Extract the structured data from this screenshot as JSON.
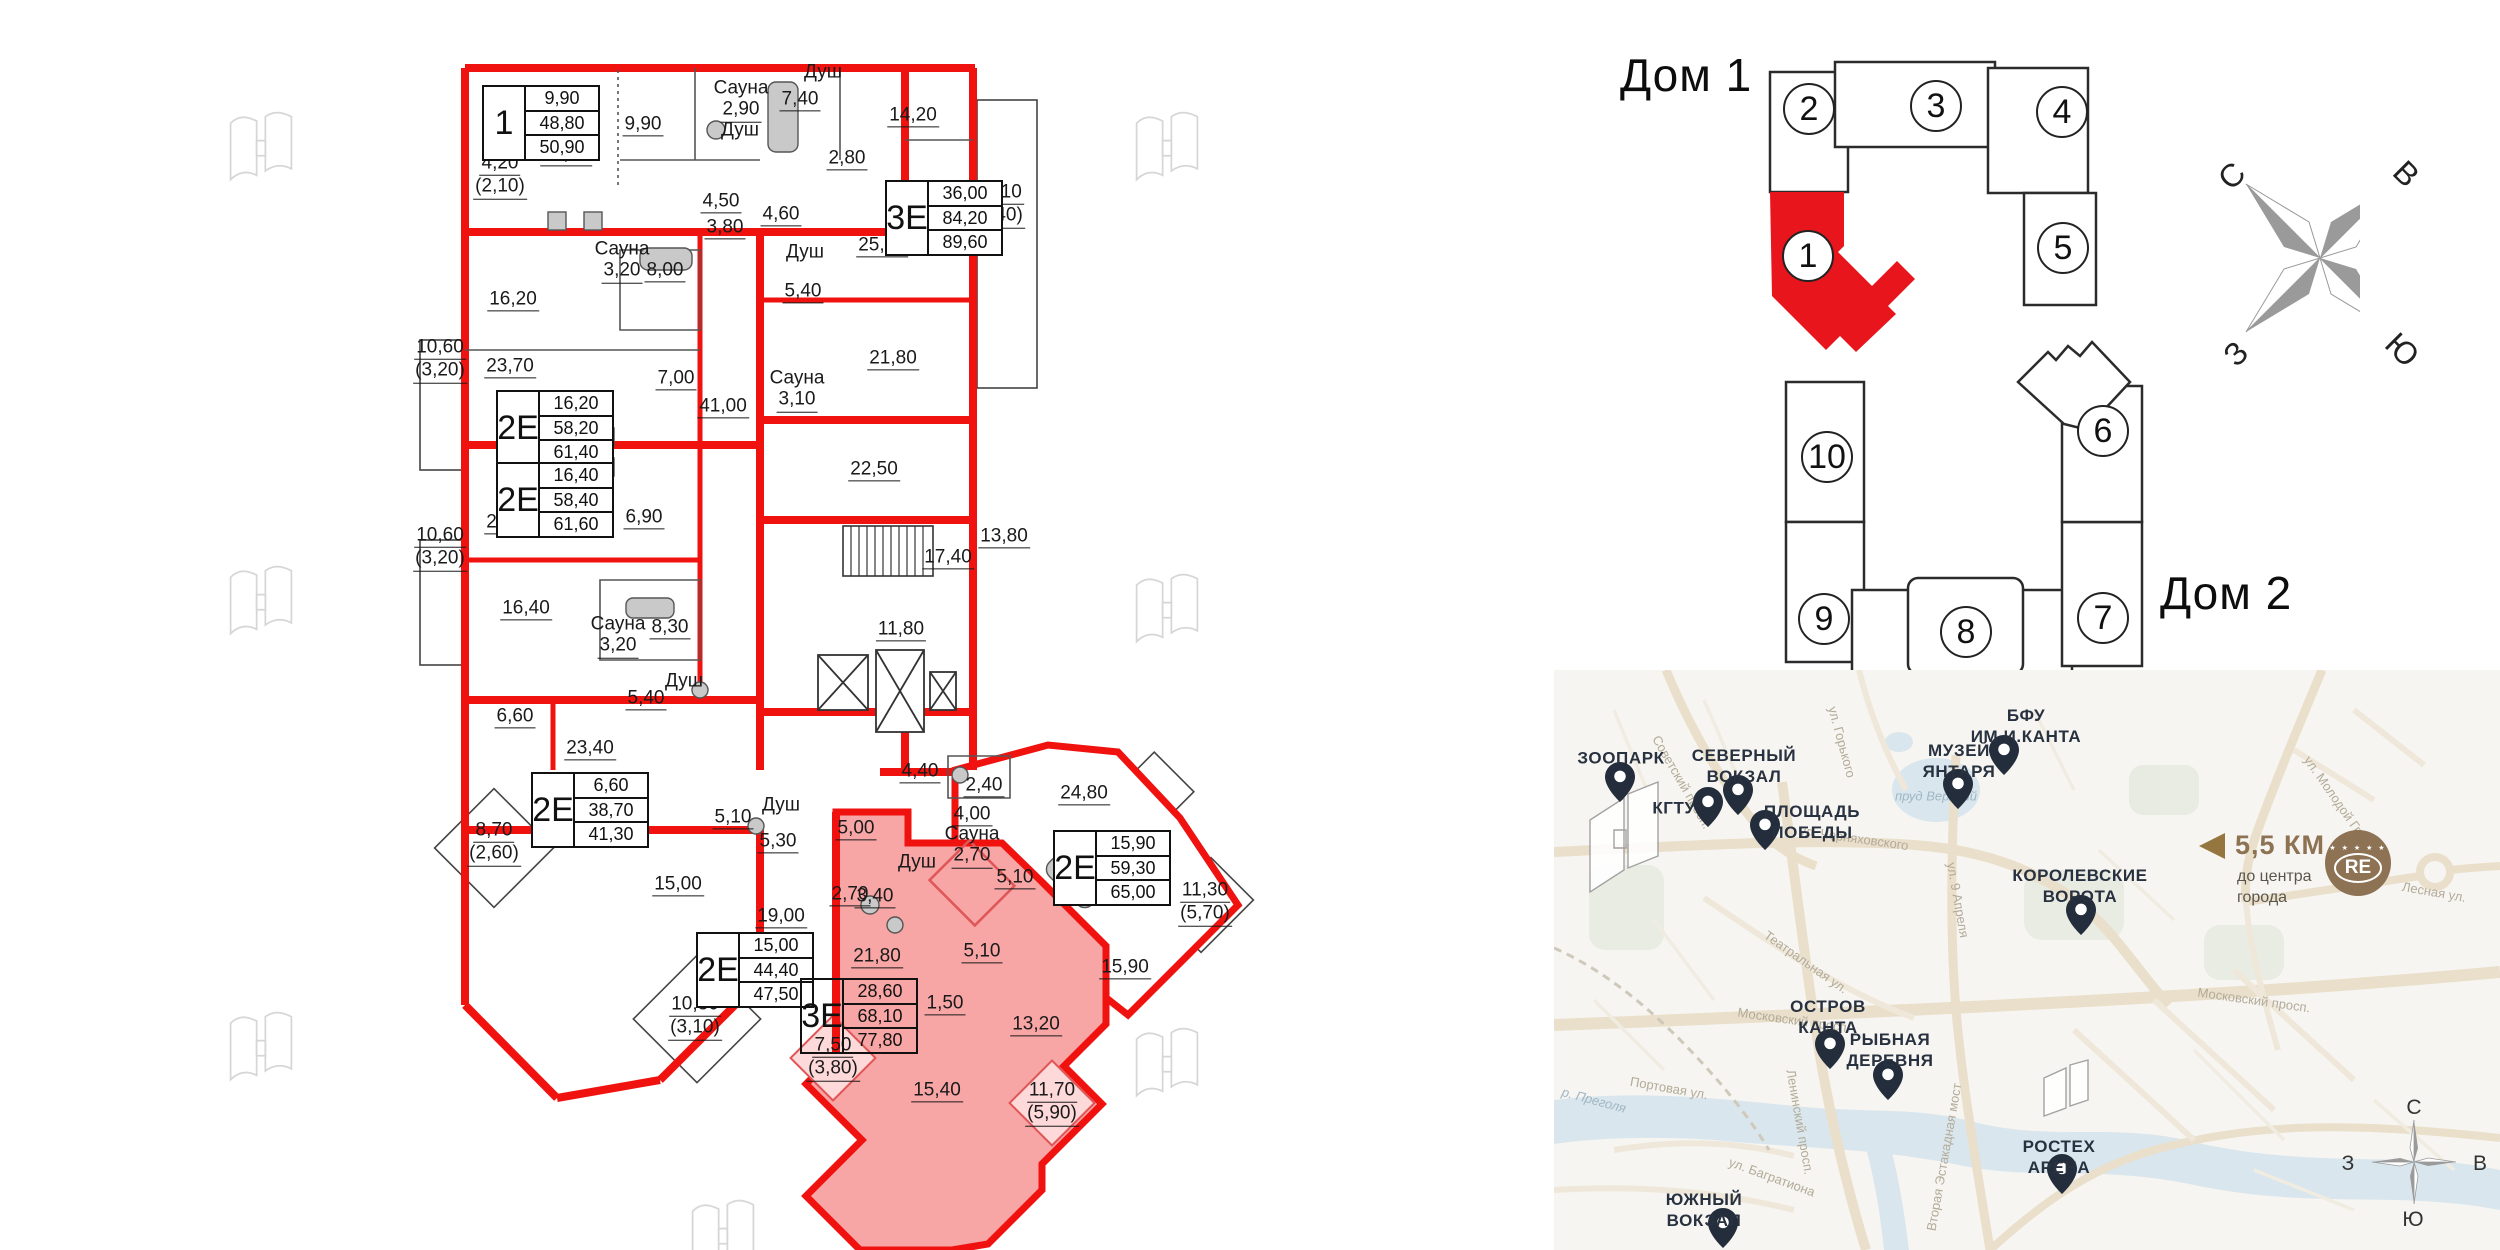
{
  "floorplan": {
    "unit_tables": [
      {
        "type": "1",
        "v1": "9,90",
        "v2": "48,80",
        "v3": "50,90",
        "x": 482,
        "y": 85
      },
      {
        "type": "3Е",
        "v1": "36,00",
        "v2": "84,20",
        "v3": "89,60",
        "x": 885,
        "y": 180
      },
      {
        "type": "2Е",
        "v1": "16,20",
        "v2": "58,20",
        "v3": "61,40",
        "x": 496,
        "y": 390
      },
      {
        "type": "2Е",
        "v1": "16,40",
        "v2": "58,40",
        "v3": "61,60",
        "x": 496,
        "y": 462
      },
      {
        "type": "2Е",
        "v1": "6,60",
        "v2": "38,70",
        "v3": "41,30",
        "x": 531,
        "y": 772
      },
      {
        "type": "2Е",
        "v1": "15,00",
        "v2": "44,40",
        "v3": "47,50",
        "x": 696,
        "y": 932
      },
      {
        "type": "3Е",
        "v1": "28,60",
        "v2": "68,10",
        "v3": "77,80",
        "x": 800,
        "y": 978,
        "cls": "hl"
      },
      {
        "type": "2Е",
        "v1": "15,90",
        "v2": "59,30",
        "v3": "65,00",
        "x": 1053,
        "y": 830
      }
    ],
    "labels": [
      {
        "w": "Сауна",
        "l1": "2,90",
        "x": 741,
        "y": 100
      },
      {
        "w": "Душ",
        "x": 823,
        "y": 72
      },
      {
        "l1": "7,40",
        "x": 800,
        "y": 100
      },
      {
        "l1": "14,20",
        "x": 913,
        "y": 116
      },
      {
        "l1": "2,80",
        "x": 847,
        "y": 159
      },
      {
        "w": "Душ",
        "x": 740,
        "y": 130
      },
      {
        "l1": "9,90",
        "x": 643,
        "y": 125
      },
      {
        "l1": "21,80",
        "x": 566,
        "y": 155
      },
      {
        "l1": "4,50",
        "x": 721,
        "y": 202
      },
      {
        "l1": "3,80",
        "x": 725,
        "y": 228
      },
      {
        "l1": "4,20",
        "l2": "(2,10)",
        "x": 500,
        "y": 176
      },
      {
        "l1": "4,60",
        "x": 781,
        "y": 215
      },
      {
        "w": "Душ",
        "x": 805,
        "y": 252
      },
      {
        "l1": "5,40",
        "x": 803,
        "y": 292
      },
      {
        "w": "Сауна",
        "l1": "3,10",
        "x": 797,
        "y": 390
      },
      {
        "l1": "25,00",
        "x": 882,
        "y": 246
      },
      {
        "l1": "21,80",
        "x": 893,
        "y": 359
      },
      {
        "l1": "22,50",
        "x": 874,
        "y": 470
      },
      {
        "l1": "18,10",
        "l2": "(5,40)",
        "x": 998,
        "y": 205
      },
      {
        "l1": "16,20",
        "x": 513,
        "y": 300
      },
      {
        "w": "Сауна",
        "l1": "3,20",
        "x": 622,
        "y": 261
      },
      {
        "l1": "8,00",
        "x": 665,
        "y": 271
      },
      {
        "l1": "23,70",
        "x": 510,
        "y": 367
      },
      {
        "l1": "7,00",
        "x": 676,
        "y": 379
      },
      {
        "l1": "41,00",
        "x": 723,
        "y": 407
      },
      {
        "l1": "10,60",
        "l2": "(3,20)",
        "x": 440,
        "y": 360
      },
      {
        "l1": "10,60",
        "l2": "(3,20)",
        "x": 440,
        "y": 548
      },
      {
        "l1": "23,60",
        "x": 510,
        "y": 523
      },
      {
        "l1": "6,90",
        "x": 644,
        "y": 518
      },
      {
        "l1": "16,40",
        "x": 526,
        "y": 609
      },
      {
        "w": "Сауна",
        "l1": "3,20",
        "x": 618,
        "y": 636
      },
      {
        "l1": "8,30",
        "x": 670,
        "y": 628
      },
      {
        "l1": "17,40",
        "x": 948,
        "y": 558
      },
      {
        "l1": "13,80",
        "x": 1004,
        "y": 537
      },
      {
        "l1": "11,80",
        "x": 901,
        "y": 630
      },
      {
        "w": "Душ",
        "x": 684,
        "y": 681
      },
      {
        "l1": "5,40",
        "x": 646,
        "y": 699
      },
      {
        "l1": "6,60",
        "x": 515,
        "y": 717
      },
      {
        "l1": "23,40",
        "x": 590,
        "y": 749
      },
      {
        "l1": "8,70",
        "l2": "(2,60)",
        "x": 494,
        "y": 843
      },
      {
        "l1": "5,10",
        "x": 733,
        "y": 818
      },
      {
        "w": "Душ",
        "x": 781,
        "y": 805
      },
      {
        "l1": "5,30",
        "x": 778,
        "y": 842
      },
      {
        "l1": "15,00",
        "x": 678,
        "y": 885
      },
      {
        "l1": "19,00",
        "x": 781,
        "y": 917
      },
      {
        "l1": "10,30",
        "l2": "(3,10)",
        "x": 695,
        "y": 1017
      },
      {
        "l1": "5,00",
        "x": 856,
        "y": 829
      },
      {
        "l1": "2,70",
        "x": 850,
        "y": 895
      },
      {
        "l1": "3,40",
        "x": 875,
        "y": 897
      },
      {
        "w": "Душ",
        "x": 917,
        "y": 862
      },
      {
        "w": "Сауна",
        "l1": "2,70",
        "x": 972,
        "y": 846
      },
      {
        "l1": "5,10",
        "x": 1015,
        "y": 878
      },
      {
        "l1": "4,40",
        "x": 920,
        "y": 772
      },
      {
        "l1": "4,00",
        "x": 972,
        "y": 815
      },
      {
        "l1": "2,40",
        "x": 984,
        "y": 786
      },
      {
        "l1": "24,80",
        "x": 1084,
        "y": 794
      },
      {
        "l1": "21,80",
        "x": 877,
        "y": 957
      },
      {
        "l1": "5,10",
        "x": 982,
        "y": 952
      },
      {
        "l1": "1,50",
        "x": 945,
        "y": 1004
      },
      {
        "l1": "13,20",
        "x": 1036,
        "y": 1025
      },
      {
        "l1": "15,40",
        "x": 937,
        "y": 1091
      },
      {
        "l1": "7,50",
        "l2": "(3,80)",
        "x": 833,
        "y": 1058
      },
      {
        "l1": "11,70",
        "l2": "(5,90)",
        "x": 1052,
        "y": 1103
      },
      {
        "l1": "11,30",
        "l2": "(5,70)",
        "x": 1205,
        "y": 903
      },
      {
        "l1": "15,90",
        "x": 1125,
        "y": 968
      }
    ]
  },
  "site_plan": {
    "house1_label": "Дом 1",
    "house2_label": "Дом 2",
    "sections": [
      {
        "num": "2",
        "x": 1809,
        "y": 109
      },
      {
        "num": "3",
        "x": 1936,
        "y": 106
      },
      {
        "num": "4",
        "x": 2062,
        "y": 112
      },
      {
        "num": "5",
        "x": 2063,
        "y": 248
      },
      {
        "num": "1",
        "x": 1808,
        "y": 256
      },
      {
        "num": "10",
        "x": 1827,
        "y": 457
      },
      {
        "num": "9",
        "x": 1824,
        "y": 619
      },
      {
        "num": "8",
        "x": 1966,
        "y": 632
      },
      {
        "num": "7",
        "x": 2103,
        "y": 618
      },
      {
        "num": "6",
        "x": 2103,
        "y": 431
      }
    ],
    "compass_points": [
      {
        "t": "С",
        "x": 2232,
        "y": 176,
        "cls": "rm45"
      },
      {
        "t": "В",
        "x": 2406,
        "y": 174,
        "cls": "r45"
      },
      {
        "t": "З",
        "x": 2236,
        "y": 354,
        "cls": "rm45"
      },
      {
        "t": "Ю",
        "x": 2402,
        "y": 350,
        "cls": "r45"
      }
    ]
  },
  "map": {
    "pins": [
      {
        "x": 66,
        "y": 132
      },
      {
        "x": 154,
        "y": 157
      },
      {
        "x": 184,
        "y": 145
      },
      {
        "x": 211,
        "y": 180
      },
      {
        "x": 404,
        "y": 139
      },
      {
        "x": 450,
        "y": 105
      },
      {
        "x": 527,
        "y": 265
      },
      {
        "x": 276,
        "y": 399
      },
      {
        "x": 334,
        "y": 430
      },
      {
        "x": 169,
        "y": 578
      },
      {
        "x": 508,
        "y": 524
      }
    ],
    "labels": [
      {
        "l1": "ЗООПАРК",
        "x": 67,
        "y": 88
      },
      {
        "l1": "КГТУ",
        "x": 120,
        "y": 138
      },
      {
        "l1": "СЕВЕРНЫЙ",
        "l2": "ВОКЗАЛ",
        "x": 190,
        "y": 96
      },
      {
        "l1": "ПЛОЩАДЬ",
        "l2": "ПОБЕДЫ",
        "x": 258,
        "y": 152
      },
      {
        "l1": "МУЗЕЙ",
        "l2": "ЯНТАРЯ",
        "x": 405,
        "y": 91
      },
      {
        "l1": "БФУ",
        "l2": "ИМ.И.КАНТА",
        "x": 472,
        "y": 56
      },
      {
        "l1": "КОРОЛЕВСКИЕ",
        "l2": "ВОРОТА",
        "x": 526,
        "y": 216
      },
      {
        "l1": "ОСТРОВ",
        "l2": "КАНТА",
        "x": 274,
        "y": 347
      },
      {
        "l1": "РЫБНАЯ",
        "l2": "ДЕРЕВНЯ",
        "x": 336,
        "y": 380
      },
      {
        "l1": "ЮЖНЫЙ",
        "l2": "ВОКЗАЛ",
        "x": 150,
        "y": 540
      },
      {
        "l1": "РОСТЕХ",
        "l2": "АРЕНА",
        "x": 505,
        "y": 487
      }
    ],
    "streets": [
      {
        "t": "Советский просп.",
        "x": 128,
        "y": 112,
        "cls": "r60"
      },
      {
        "t": "ул. Горького",
        "x": 288,
        "y": 72,
        "cls": "r75"
      },
      {
        "t": "ул. Черняховского",
        "x": 300,
        "y": 168,
        "cls": "r8"
      },
      {
        "t": "ул. 9 Апреля",
        "x": 404,
        "y": 230,
        "cls": "r80"
      },
      {
        "t": "пруд Верхний",
        "x": 382,
        "y": 126,
        "cls": "wt"
      },
      {
        "t": "Московский просп.",
        "x": 240,
        "y": 350,
        "cls": "r8"
      },
      {
        "t": "Московский просп.",
        "x": 700,
        "y": 330,
        "cls": "r8"
      },
      {
        "t": "Ленинский просп.",
        "x": 246,
        "y": 452,
        "cls": "r80"
      },
      {
        "t": "Театральная ул.",
        "x": 252,
        "y": 292,
        "cls": "r35"
      },
      {
        "t": "Портовая ул.",
        "x": 115,
        "y": 418,
        "cls": "r10"
      },
      {
        "t": "р. Преголя",
        "x": 40,
        "y": 430,
        "cls": "r15 wt"
      },
      {
        "t": "ул. Молодой Гвардии",
        "x": 790,
        "y": 140,
        "cls": "r55"
      },
      {
        "t": "Вторая Эстакадная мост",
        "x": 390,
        "y": 487,
        "cls": "rm80"
      },
      {
        "t": "ул. Багратиона",
        "x": 218,
        "y": 507,
        "cls": "r20"
      },
      {
        "t": "Лесная ул.",
        "x": 880,
        "y": 222,
        "cls": "r10"
      }
    ],
    "distance": {
      "km": "5,5 КМ",
      "sub1": "до центра",
      "sub2": "города"
    },
    "brand": {
      "stars": "★ ★ ★ ★ ★",
      "label": "RE"
    },
    "compass_points": [
      {
        "t": "С",
        "x": 860,
        "y": 438
      },
      {
        "t": "В",
        "x": 926,
        "y": 494
      },
      {
        "t": "З",
        "x": 794,
        "y": 494
      },
      {
        "t": "Ю",
        "x": 859,
        "y": 550
      }
    ]
  }
}
